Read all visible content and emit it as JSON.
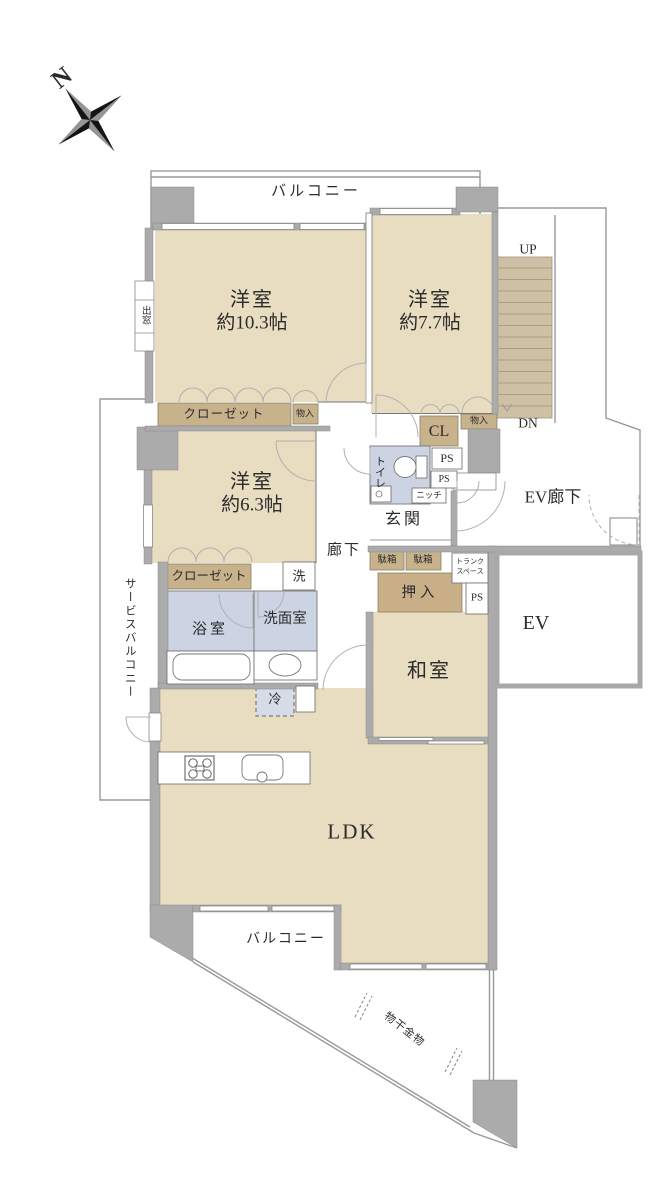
{
  "title": "マンション間取り図",
  "compass": {
    "north": "N"
  },
  "labels": {
    "balcony_top": "バルコニー",
    "balcony_bottom": "バルコニー",
    "service_balcony": "サービスバルコニー",
    "room1_name": "洋室",
    "room1_size": "約10.3帖",
    "room2_name": "洋室",
    "room2_size": "約7.7帖",
    "room3_name": "洋室",
    "room3_size": "約6.3帖",
    "japanese_room": "和室",
    "ldk": "LDK",
    "entrance": "玄関",
    "hallway": "廊下",
    "ev_hall": "EV廊下",
    "ev": "EV",
    "bathroom": "浴室",
    "washroom": "洗面室",
    "toilet": "トイレ",
    "closet_top": "クローゼット",
    "closet_bottom": "クローゼット",
    "cl": "CL",
    "oshiire": "押入",
    "monoire_top": "物入",
    "monoire_right": "物入",
    "shoe_box_1": "駄箱",
    "shoe_box_2": "駄箱",
    "trunk_line1": "トランク",
    "trunk_line2": "スペース",
    "ps_toilet_1": "PS",
    "ps_toilet_2": "PS",
    "ps_ev": "PS",
    "niche": "ニッチ",
    "washing_machine": "洗",
    "refrigerator": "冷",
    "bay_window": "出窓",
    "laundry_hardware": "物干金物",
    "stairs_up": "UP",
    "stairs_dn": "DN"
  },
  "colors": {
    "room_floor": "#e8ddc1",
    "closet": "#c7b28c",
    "oshiire": "#c9af87",
    "water_area": "#ccd3e2",
    "refrigerator_area": "#d6dbe8",
    "wall": "#ababab",
    "stairs": "#cec0a4",
    "outline": "#999999",
    "text": "#2b2b2b"
  }
}
